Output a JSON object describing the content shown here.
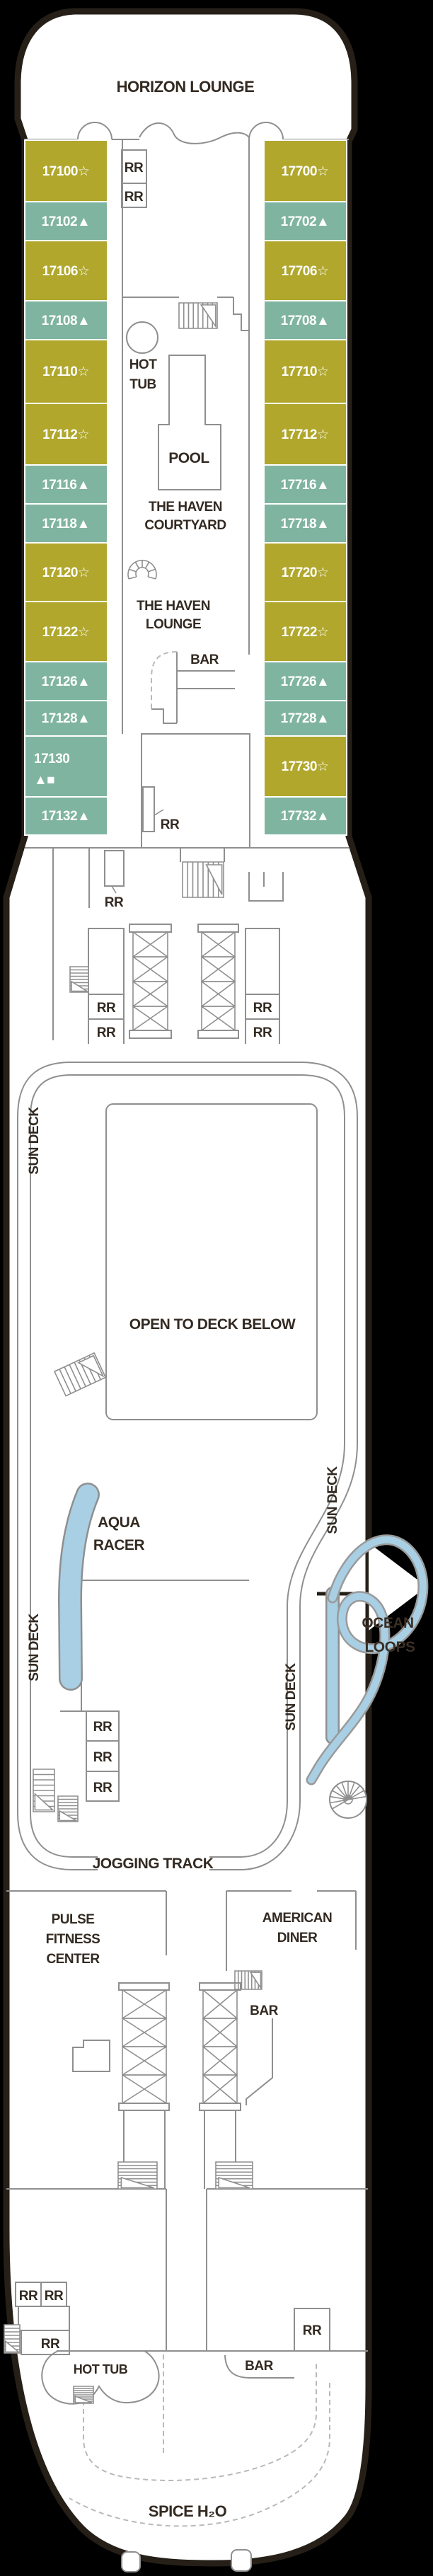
{
  "colors": {
    "background": "#000000",
    "hull_fill": "#ffffff",
    "hull_outline": "#251f17",
    "wall": "#8f8f8f",
    "label": "#332a22",
    "cabin_star": "#b0a72c",
    "cabin_triangle": "#7fb4a1",
    "water": "#a9cfe4",
    "dashed": "#b9b9b9",
    "cabin_text": "#ffffff"
  },
  "ship": {
    "deck_bow_label": "HORIZON LOUNGE",
    "deck_stern_label": "SPICE H₂O"
  },
  "cabins": {
    "left": [
      {
        "label": "17100☆",
        "fill": "#b0a72c"
      },
      {
        "label": "17102▲",
        "fill": "#7fb4a1"
      },
      {
        "label": "17106☆",
        "fill": "#b0a72c"
      },
      {
        "label": "17108▲",
        "fill": "#7fb4a1"
      },
      {
        "label": "17110☆",
        "fill": "#b0a72c"
      },
      {
        "label": "17112☆",
        "fill": "#b0a72c"
      },
      {
        "label": "17116▲",
        "fill": "#7fb4a1"
      },
      {
        "label": "17118▲",
        "fill": "#7fb4a1"
      },
      {
        "label": "17120☆",
        "fill": "#b0a72c"
      },
      {
        "label": "17122☆",
        "fill": "#b0a72c"
      },
      {
        "label": "17126▲",
        "fill": "#7fb4a1"
      },
      {
        "label": "17128▲",
        "fill": "#7fb4a1"
      },
      {
        "label": "17130",
        "symbols": "▲■",
        "fill": "#7fb4a1"
      },
      {
        "label": "17132▲",
        "fill": "#7fb4a1"
      }
    ],
    "right": [
      {
        "label": "17700☆",
        "fill": "#b0a72c"
      },
      {
        "label": "17702▲",
        "fill": "#7fb4a1"
      },
      {
        "label": "17706☆",
        "fill": "#b0a72c"
      },
      {
        "label": "17708▲",
        "fill": "#7fb4a1"
      },
      {
        "label": "17710☆",
        "fill": "#b0a72c"
      },
      {
        "label": "17712☆",
        "fill": "#b0a72c"
      },
      {
        "label": "17716▲",
        "fill": "#7fb4a1"
      },
      {
        "label": "17718▲",
        "fill": "#7fb4a1"
      },
      {
        "label": "17720☆",
        "fill": "#b0a72c"
      },
      {
        "label": "17722☆",
        "fill": "#b0a72c"
      },
      {
        "label": "17726▲",
        "fill": "#7fb4a1"
      },
      {
        "label": "17728▲",
        "fill": "#7fb4a1"
      },
      {
        "label": "17730☆",
        "fill": "#b0a72c"
      },
      {
        "label": "17732▲",
        "fill": "#7fb4a1"
      }
    ]
  },
  "areas": {
    "hot_tub1": "HOT",
    "hot_tub2": "TUB",
    "pool": "POOL",
    "courtyard1": "THE HAVEN",
    "courtyard2": "COURTYARD",
    "lounge1": "THE HAVEN",
    "lounge2": "LOUNGE",
    "open_below": "OPEN TO DECK BELOW",
    "aqua1": "AQUA",
    "aqua2": "RACER",
    "ocean1": "OCEAN",
    "ocean2": "LOOPS",
    "jogging": "JOGGING TRACK",
    "fitness1": "PULSE",
    "fitness2": "FITNESS",
    "fitness3": "CENTER",
    "diner1": "AMERICAN",
    "diner2": "DINER"
  },
  "labels": {
    "rr": "RR",
    "bar": "BAR",
    "sun_deck": "SUN DECK",
    "hot_tub": "HOT TUB"
  }
}
